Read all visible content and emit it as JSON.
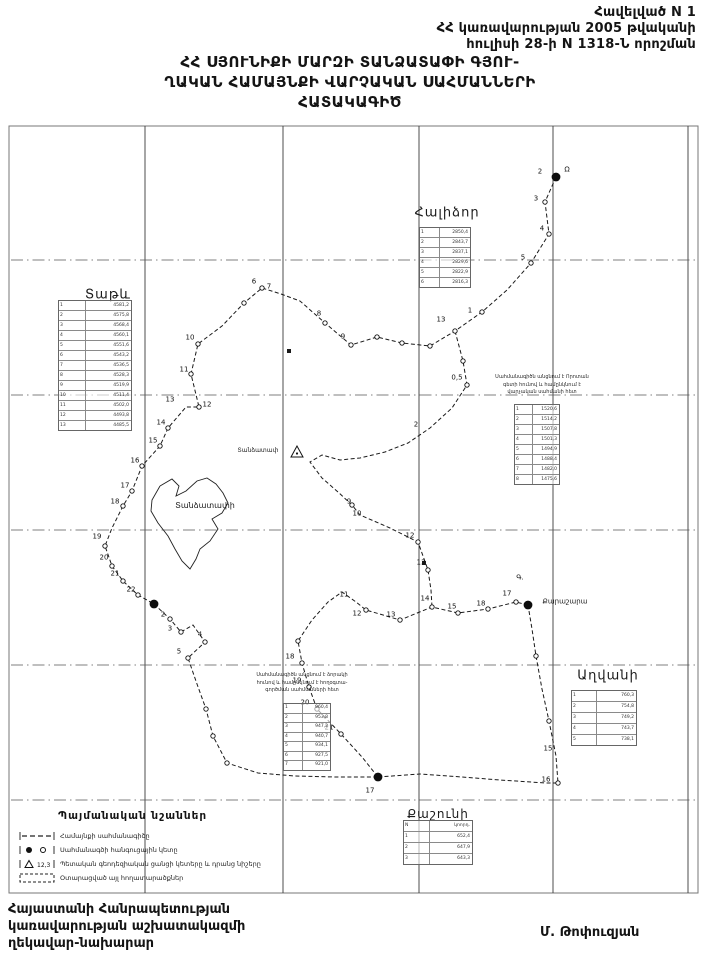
{
  "header": {
    "line1": "Հավելված N  1",
    "line2": "ՀՀ կառավարության 2005 թվականի",
    "line3": "հուլիսի 28-ի N 1318-Ն որոշման"
  },
  "title": {
    "line1": "ՀՀ  ՍՅՈՒՆԻՔԻ  ՄԱՐԶԻ  ՏԱՆՁԱՏԱՓԻ ԳՅՈՒ-",
    "line2": "ՂԱԿԱՆ ՀԱՄԱՅՆՔԻ ՎԱՐՉԱԿԱՆ ՍԱՀՄԱՆՆԵՐԻ",
    "line3": "ՀԱՏԱԿԱԳԻԾ"
  },
  "footer": {
    "line1": "Հայաստանի Հանրապետության",
    "line2": "կառավարության աշխատակազմի",
    "line3": "ղեկավար-նախարար",
    "signature": "Մ. Թոփուզյան"
  },
  "legend": {
    "title": "Պայմանական նշաններ",
    "items": [
      {
        "symbol": "boundary-line",
        "label": "Համայնքի սահմանագիծը"
      },
      {
        "symbol": "junction-point",
        "label": "Սահմանագծի հանգուցային կետը"
      },
      {
        "symbol": "geodetic-point",
        "label": "Պետական գեոդեզիական ցանցի կետերը և դրանց նիշերը",
        "mark": "12,3"
      },
      {
        "symbol": "allotted-area",
        "label": "Օտարացված այլ հողատարածքներ"
      }
    ]
  },
  "map": {
    "ink": "#1a1a1a",
    "frame": {
      "x": 9,
      "y": 126,
      "w": 689,
      "h": 767
    },
    "grid": {
      "verticals": [
        145,
        283,
        419,
        553,
        688
      ],
      "horizontals": [
        260,
        395,
        530,
        665,
        800
      ]
    },
    "paths": [
      {
        "name": "boundary-north-west",
        "points": [
          [
            556,
            177
          ],
          [
            545,
            202
          ],
          [
            549,
            234
          ],
          [
            531,
            263
          ],
          [
            507,
            290
          ],
          [
            482,
            312
          ],
          [
            455,
            331
          ],
          [
            430,
            346
          ],
          [
            402,
            343
          ],
          [
            377,
            337
          ],
          [
            351,
            345
          ],
          [
            325,
            323
          ],
          [
            300,
            301
          ],
          [
            281,
            294
          ],
          [
            262,
            288
          ],
          [
            244,
            303
          ],
          [
            222,
            326
          ],
          [
            198,
            344
          ],
          [
            191,
            374
          ],
          [
            199,
            407
          ],
          [
            186,
            407
          ],
          [
            168,
            428
          ],
          [
            160,
            446
          ],
          [
            142,
            466
          ],
          [
            132,
            491
          ],
          [
            123,
            506
          ],
          [
            112,
            528
          ],
          [
            105,
            546
          ],
          [
            112,
            566
          ],
          [
            123,
            581
          ],
          [
            138,
            595
          ],
          [
            154,
            604
          ]
        ]
      },
      {
        "name": "boundary-south-west",
        "points": [
          [
            154,
            604
          ],
          [
            170,
            619
          ],
          [
            181,
            632
          ],
          [
            193,
            625
          ],
          [
            205,
            642
          ],
          [
            188,
            658
          ],
          [
            197,
            684
          ],
          [
            206,
            709
          ],
          [
            213,
            736
          ],
          [
            227,
            763
          ],
          [
            258,
            773
          ],
          [
            295,
            776
          ],
          [
            335,
            777
          ],
          [
            378,
            777
          ]
        ]
      },
      {
        "name": "boundary-south-east",
        "points": [
          [
            378,
            777
          ],
          [
            420,
            774
          ],
          [
            462,
            777
          ],
          [
            500,
            780
          ],
          [
            546,
            783
          ],
          [
            558,
            783
          ],
          [
            556,
            756
          ],
          [
            549,
            721
          ],
          [
            542,
            689
          ],
          [
            536,
            656
          ],
          [
            532,
            629
          ],
          [
            528,
            605
          ]
        ]
      },
      {
        "name": "boundary-middle",
        "points": [
          [
            528,
            605
          ],
          [
            516,
            602
          ],
          [
            488,
            609
          ],
          [
            458,
            613
          ],
          [
            432,
            607
          ],
          [
            400,
            620
          ],
          [
            366,
            610
          ],
          [
            356,
            602
          ],
          [
            342,
            592
          ],
          [
            328,
            602
          ],
          [
            312,
            620
          ],
          [
            298,
            641
          ],
          [
            302,
            663
          ],
          [
            309,
            687
          ],
          [
            317,
            709
          ],
          [
            341,
            734
          ],
          [
            362,
            757
          ],
          [
            378,
            777
          ]
        ]
      },
      {
        "name": "boundary-inner-east",
        "points": [
          [
            455,
            331
          ],
          [
            463,
            361
          ],
          [
            467,
            385
          ],
          [
            452,
            408
          ],
          [
            430,
            428
          ],
          [
            408,
            443
          ],
          [
            385,
            452
          ],
          [
            360,
            458
          ],
          [
            340,
            460
          ],
          [
            322,
            455
          ],
          [
            310,
            462
          ],
          [
            322,
            478
          ],
          [
            338,
            492
          ],
          [
            352,
            505
          ],
          [
            360,
            515
          ],
          [
            390,
            528
          ],
          [
            418,
            542
          ],
          [
            428,
            570
          ],
          [
            431,
            590
          ],
          [
            432,
            607
          ]
        ]
      }
    ],
    "village_polygon": {
      "points": [
        [
          160,
          486
        ],
        [
          172,
          479
        ],
        [
          179,
          486
        ],
        [
          176,
          496
        ],
        [
          186,
          491
        ],
        [
          197,
          481
        ],
        [
          207,
          478
        ],
        [
          216,
          484
        ],
        [
          223,
          493
        ],
        [
          228,
          503
        ],
        [
          222,
          513
        ],
        [
          212,
          519
        ],
        [
          218,
          529
        ],
        [
          210,
          541
        ],
        [
          200,
          549
        ],
        [
          196,
          559
        ],
        [
          190,
          569
        ],
        [
          182,
          561
        ],
        [
          175,
          549
        ],
        [
          168,
          536
        ],
        [
          158,
          523
        ],
        [
          151,
          511
        ],
        [
          152,
          500
        ],
        [
          160,
          486
        ]
      ]
    },
    "place_labels": [
      {
        "text": "Տաթև",
        "x": 108,
        "y": 295,
        "size": 13,
        "ls": 1
      },
      {
        "text": "Հալիձոր",
        "x": 447,
        "y": 213,
        "size": 13,
        "ls": 1
      },
      {
        "text": "Աղվանի",
        "x": 608,
        "y": 676,
        "size": 13,
        "ls": 1
      },
      {
        "text": "Քաշունի",
        "x": 438,
        "y": 814,
        "size": 12,
        "ls": 1
      },
      {
        "text": "Տանձատափի",
        "x": 205,
        "y": 506,
        "size": 8,
        "ls": 0
      },
      {
        "text": "Տանձատափ",
        "x": 258,
        "y": 451,
        "size": 6,
        "ls": 0
      },
      {
        "text": "Քարաշարա",
        "x": 565,
        "y": 602,
        "size": 7,
        "ls": 0
      }
    ],
    "vertex_labels": [
      {
        "t": "2",
        "x": 540,
        "y": 172
      },
      {
        "t": "Ω",
        "x": 567,
        "y": 170
      },
      {
        "t": "3",
        "x": 536,
        "y": 199
      },
      {
        "t": "4",
        "x": 542,
        "y": 229
      },
      {
        "t": "5",
        "x": 523,
        "y": 258
      },
      {
        "t": "1",
        "x": 470,
        "y": 311
      },
      {
        "t": "13",
        "x": 441,
        "y": 320
      },
      {
        "t": "8",
        "x": 319,
        "y": 314
      },
      {
        "t": "9",
        "x": 343,
        "y": 337
      },
      {
        "t": "6",
        "x": 254,
        "y": 282
      },
      {
        "t": "7",
        "x": 269,
        "y": 287
      },
      {
        "t": "10",
        "x": 190,
        "y": 338
      },
      {
        "t": "11",
        "x": 184,
        "y": 370
      },
      {
        "t": "12",
        "x": 207,
        "y": 405
      },
      {
        "t": "13",
        "x": 170,
        "y": 400
      },
      {
        "t": "14",
        "x": 161,
        "y": 423
      },
      {
        "t": "15",
        "x": 153,
        "y": 441
      },
      {
        "t": "16",
        "x": 135,
        "y": 461
      },
      {
        "t": "17",
        "x": 125,
        "y": 486
      },
      {
        "t": "18",
        "x": 115,
        "y": 502
      },
      {
        "t": "19",
        "x": 97,
        "y": 537
      },
      {
        "t": "20",
        "x": 104,
        "y": 558
      },
      {
        "t": "21",
        "x": 115,
        "y": 574
      },
      {
        "t": "22",
        "x": 131,
        "y": 590
      },
      {
        "t": "2",
        "x": 163,
        "y": 615
      },
      {
        "t": "3",
        "x": 170,
        "y": 629
      },
      {
        "t": "4",
        "x": 200,
        "y": 635
      },
      {
        "t": "5",
        "x": 179,
        "y": 652
      },
      {
        "t": "18",
        "x": 290,
        "y": 657
      },
      {
        "t": "19",
        "x": 297,
        "y": 681
      },
      {
        "t": "20",
        "x": 305,
        "y": 703
      },
      {
        "t": "21",
        "x": 329,
        "y": 728
      },
      {
        "t": "17",
        "x": 370,
        "y": 791
      },
      {
        "t": "16",
        "x": 546,
        "y": 780
      },
      {
        "t": "15",
        "x": 548,
        "y": 749
      },
      {
        "t": "11",
        "x": 344,
        "y": 595
      },
      {
        "t": "12",
        "x": 357,
        "y": 614
      },
      {
        "t": "13",
        "x": 391,
        "y": 615
      },
      {
        "t": "14",
        "x": 425,
        "y": 599
      },
      {
        "t": "15",
        "x": 452,
        "y": 607
      },
      {
        "t": "18",
        "x": 481,
        "y": 604
      },
      {
        "t": "17",
        "x": 507,
        "y": 594
      },
      {
        "t": "0,5",
        "x": 457,
        "y": 378
      },
      {
        "t": "2",
        "x": 416,
        "y": 425
      },
      {
        "t": "9",
        "x": 349,
        "y": 502
      },
      {
        "t": "10",
        "x": 357,
        "y": 514
      },
      {
        "t": "12",
        "x": 410,
        "y": 536
      },
      {
        "t": "13",
        "x": 421,
        "y": 563
      },
      {
        "t": "Գ.",
        "x": 520,
        "y": 578
      }
    ],
    "black_dots": [
      [
        556,
        177
      ],
      [
        154,
        604
      ],
      [
        528,
        605
      ],
      [
        378,
        777
      ]
    ],
    "circles": [
      [
        545,
        202
      ],
      [
        549,
        234
      ],
      [
        531,
        263
      ],
      [
        482,
        312
      ],
      [
        455,
        331
      ],
      [
        430,
        346
      ],
      [
        402,
        343
      ],
      [
        377,
        337
      ],
      [
        351,
        345
      ],
      [
        325,
        323
      ],
      [
        262,
        288
      ],
      [
        244,
        303
      ],
      [
        198,
        344
      ],
      [
        191,
        374
      ],
      [
        199,
        407
      ],
      [
        168,
        428
      ],
      [
        160,
        446
      ],
      [
        142,
        466
      ],
      [
        132,
        491
      ],
      [
        123,
        506
      ],
      [
        105,
        546
      ],
      [
        112,
        566
      ],
      [
        123,
        581
      ],
      [
        138,
        595
      ],
      [
        170,
        619
      ],
      [
        181,
        632
      ],
      [
        205,
        642
      ],
      [
        188,
        658
      ],
      [
        206,
        709
      ],
      [
        227,
        763
      ],
      [
        298,
        641
      ],
      [
        302,
        663
      ],
      [
        309,
        687
      ],
      [
        317,
        709
      ],
      [
        341,
        734
      ],
      [
        366,
        610
      ],
      [
        400,
        620
      ],
      [
        432,
        607
      ],
      [
        458,
        613
      ],
      [
        488,
        609
      ],
      [
        516,
        602
      ],
      [
        558,
        783
      ],
      [
        549,
        721
      ],
      [
        536,
        656
      ],
      [
        467,
        385
      ],
      [
        463,
        361
      ],
      [
        352,
        505
      ],
      [
        418,
        542
      ],
      [
        428,
        570
      ],
      [
        213,
        736
      ]
    ],
    "marks": [
      [
        424,
        563
      ],
      [
        289,
        351
      ]
    ],
    "triangle": {
      "x": 297,
      "y": 452
    },
    "notes": [
      {
        "x": 486,
        "y": 374,
        "w": 112,
        "lines": [
          "Սահմանագիծն անցնում է Որոտան",
          "գետի հունով և համընկնում է",
          "վարչական սահմանի հետ"
        ]
      },
      {
        "x": 250,
        "y": 672,
        "w": 104,
        "lines": [
          "Սահմանագիծն անցնում է ձորակի",
          "հունով և համընկնում է հողօգտա-",
          "գործման սահմանների հետ"
        ]
      }
    ],
    "tables": [
      {
        "name": "tatev-coordinates",
        "x": 58,
        "y": 300,
        "w": 72,
        "row_h": 9,
        "rows": [
          [
            "1",
            "4581,2"
          ],
          [
            "2",
            "4575,8"
          ],
          [
            "3",
            "4568,4"
          ],
          [
            "4",
            "4560,1"
          ],
          [
            "5",
            "4551,6"
          ],
          [
            "6",
            "4543,2"
          ],
          [
            "7",
            "4536,5"
          ],
          [
            "8",
            "4528,3"
          ],
          [
            "9",
            "4519,9"
          ],
          [
            "10",
            "4511,4"
          ],
          [
            "11",
            "4502,0"
          ],
          [
            "12",
            "4493,8"
          ],
          [
            "13",
            "4485,5"
          ]
        ]
      },
      {
        "name": "halidzor-coordinates",
        "x": 419,
        "y": 227,
        "w": 50,
        "row_h": 9,
        "rows": [
          [
            "1",
            "2850,4"
          ],
          [
            "2",
            "2843,7"
          ],
          [
            "3",
            "2837,1"
          ],
          [
            "4",
            "2829,6"
          ],
          [
            "5",
            "2822,9"
          ],
          [
            "6",
            "2816,3"
          ]
        ]
      },
      {
        "name": "east-coordinates",
        "x": 514,
        "y": 404,
        "w": 44,
        "row_h": 9,
        "rows": [
          [
            "1",
            "1520,6"
          ],
          [
            "2",
            "1514,2"
          ],
          [
            "3",
            "1507,8"
          ],
          [
            "4",
            "1501,3"
          ],
          [
            "5",
            "1494,9"
          ],
          [
            "6",
            "1488,4"
          ],
          [
            "7",
            "1482,0"
          ],
          [
            "8",
            "1475,6"
          ]
        ]
      },
      {
        "name": "south-coordinates",
        "x": 283,
        "y": 703,
        "w": 46,
        "row_h": 8.5,
        "rows": [
          [
            "1",
            "960,4"
          ],
          [
            "2",
            "953,8"
          ],
          [
            "3",
            "947,2"
          ],
          [
            "4",
            "940,7"
          ],
          [
            "5",
            "934,1"
          ],
          [
            "6",
            "927,5"
          ],
          [
            "7",
            "921,0"
          ]
        ]
      },
      {
        "name": "aghvani-coordinates",
        "x": 571,
        "y": 690,
        "w": 64,
        "row_h": 10,
        "rows": [
          [
            "1",
            "760,3"
          ],
          [
            "2",
            "754,8"
          ],
          [
            "3",
            "749,2"
          ],
          [
            "4",
            "743,7"
          ],
          [
            "5",
            "738,1"
          ]
        ]
      },
      {
        "name": "kashuni-coordinates",
        "x": 403,
        "y": 820,
        "w": 68,
        "row_h": 10,
        "rows": [
          [
            "N",
            "կոորդ."
          ],
          [
            "1",
            "652,4"
          ],
          [
            "2",
            "647,9"
          ],
          [
            "3",
            "643,3"
          ]
        ]
      }
    ]
  }
}
